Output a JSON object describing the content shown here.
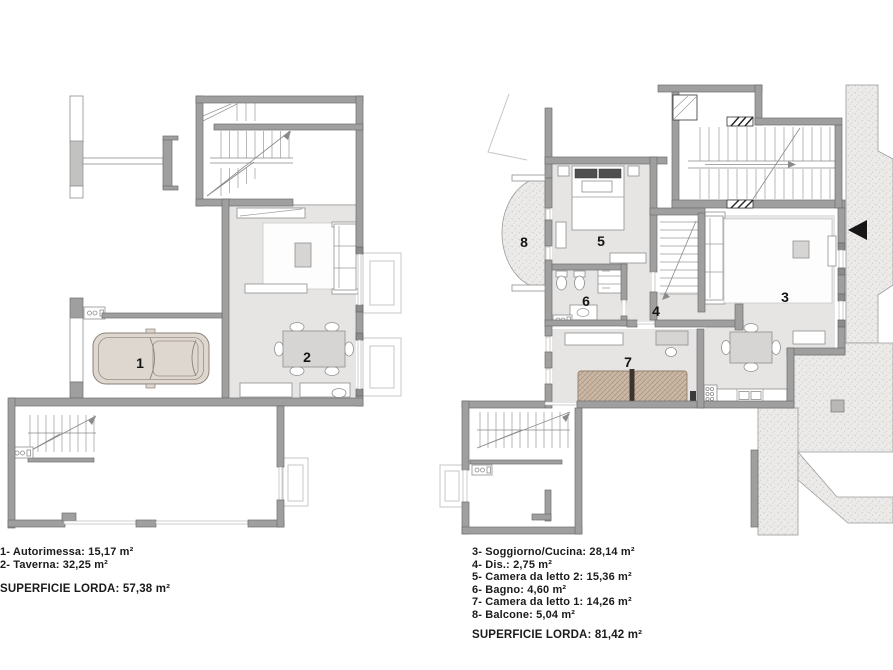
{
  "plan_left": {
    "name": "Piano interrato / taverna e autorimessa",
    "room_numbers": {
      "r1": "1",
      "r2": "2"
    },
    "rooms": [
      {
        "number": "1",
        "label": "Autorimessa",
        "area": "15,17 m²"
      },
      {
        "number": "2",
        "label": "Taverna",
        "area": "32,25 m²"
      }
    ],
    "legend_items": [
      "1- Autorimessa: 15,17 m²",
      "2- Taverna: 32,25 m²"
    ],
    "total": "SUPERFICIE LORDA: 57,38 m²"
  },
  "plan_right": {
    "name": "Piano abitazione",
    "room_numbers": {
      "r3": "3",
      "r4": "4",
      "r5": "5",
      "r6": "6",
      "r7": "7",
      "r8": "8"
    },
    "rooms": [
      {
        "number": "3",
        "label": "Soggiorno/Cucina",
        "area": "28,14 m²"
      },
      {
        "number": "4",
        "label": "Dis.",
        "area": "2,75 m²"
      },
      {
        "number": "5",
        "label": "Camera da letto 2",
        "area": "15,36 m²"
      },
      {
        "number": "6",
        "label": "Bagno",
        "area": "4,60 m²"
      },
      {
        "number": "7",
        "label": "Camera da letto 1",
        "area": "14,26 m²"
      },
      {
        "number": "8",
        "label": "Balcone",
        "area": "5,04 m²"
      }
    ],
    "legend_items": [
      "3- Soggiorno/Cucina: 28,14 m²",
      "4- Dis.: 2,75 m²",
      "5- Camera da letto 2: 15,36 m²",
      "6- Bagno: 4,60 m²",
      "7- Camera da letto 1: 14,26 m²",
      "8- Balcone: 5,04 m²"
    ],
    "total": "SUPERFICIE LORDA: 81,42 m²"
  },
  "colors": {
    "background": "#ffffff",
    "wall": "#9f9f9f",
    "floor": "#e6e5e3",
    "stipple": "#ecebe9",
    "car_body": "#ded7d0",
    "bed_tan": "#cbb8a6",
    "entry_arrow": "#161616",
    "text": "#1b1b1b"
  }
}
